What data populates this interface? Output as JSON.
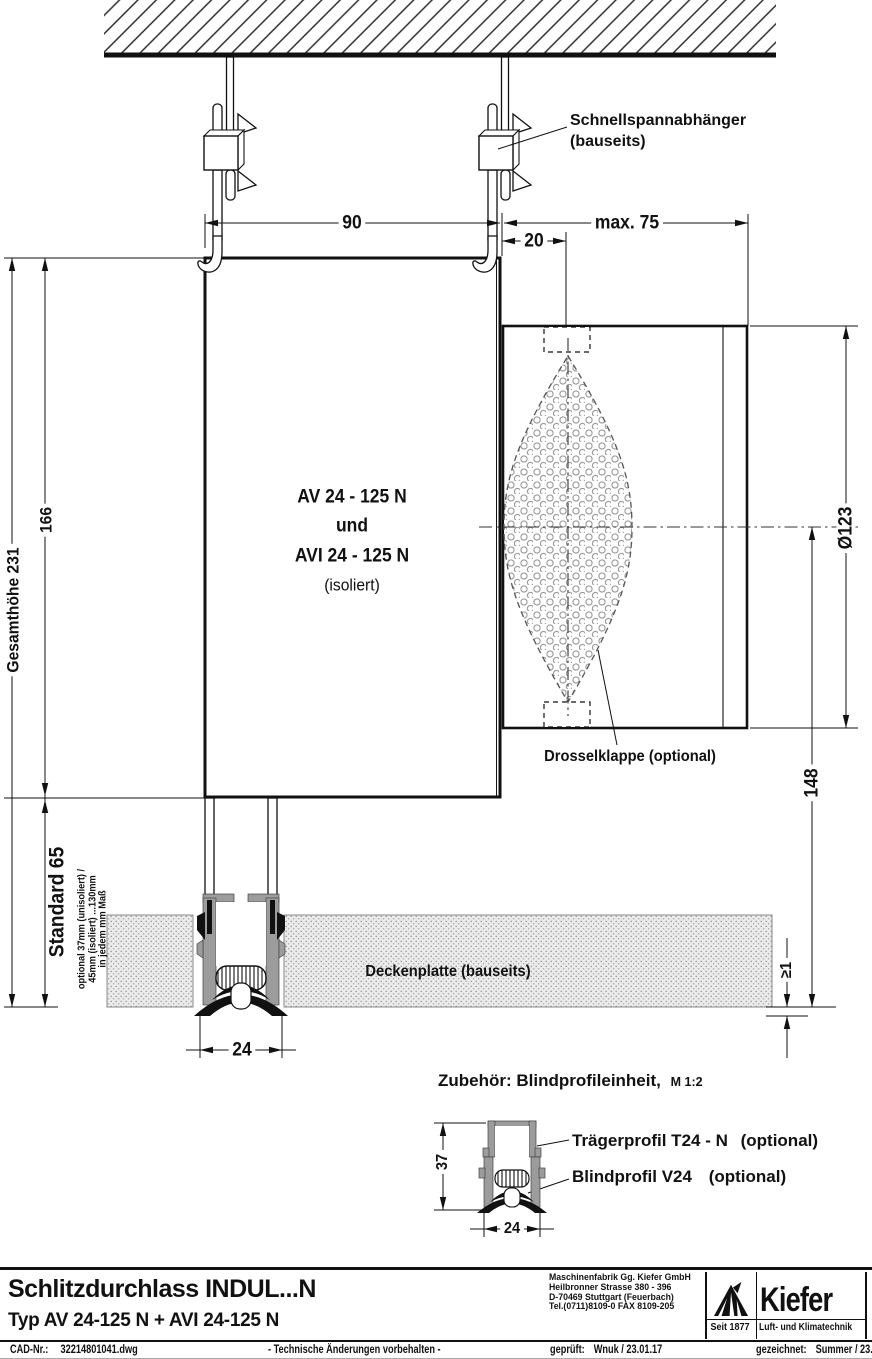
{
  "drawing": {
    "hanger_label_1": "Schnellspannabhänger",
    "hanger_label_2": "(bauseits)",
    "box_label_1": "AV 24 - 125 N",
    "box_label_2": "und",
    "box_label_3": "AVI 24 - 125 N",
    "box_label_4": "(isoliert)",
    "damper_label": "Drosselklappe (optional)",
    "ceiling_label": "Deckenplatte (bauseits)",
    "dims": {
      "hanger_spacing": "90",
      "max_offset": "max. 75",
      "axis_offset": "20",
      "total_height": "Gesamthöhe 231",
      "box_height": "166",
      "standard_height": "Standard 65",
      "optional_note_1": "optional 37mm (unisoliert) /",
      "optional_note_2": "45mm (isoliert) ...130mm",
      "optional_note_3": "in jedem mm Maß",
      "duct_diameter": "Ø123",
      "axis_to_ceiling": "148",
      "protrusion": "≥1",
      "slot_width": "24",
      "detail_height": "37",
      "detail_width": "24"
    },
    "accessory": {
      "heading": "Zubehör: Blindprofileinheit,",
      "scale": "M 1:2",
      "carrier_label": "Trägerprofil T24 - N",
      "carrier_opt": "(optional)",
      "blind_label": "Blindprofil V24",
      "blind_opt": "(optional)"
    }
  },
  "titleblock": {
    "title": "Schlitzdurchlass INDUL...N",
    "subtitle": "Typ AV 24-125 N + AVI 24-125 N",
    "company": [
      "Maschinenfabrik Gg. Kiefer GmbH",
      "Heilbronner Strasse 380 - 396",
      "D-70469 Stuttgart (Feuerbach)",
      "Tel.(0711)8109-0 FAX 8109-205"
    ],
    "brand": {
      "name": "Kiefer",
      "since": "Seit 1877",
      "tagline": "Luft- und Klimatechnik"
    },
    "cad_label": "CAD-Nr.:",
    "cad_number": "32214801041.dwg",
    "notice": "- Technische Änderungen vorbehalten -",
    "checked_label": "geprüft:",
    "checked_value": "Wnuk / 23.01.17",
    "drawn_label": "gezeichnet:",
    "drawn_value": "Summer / 23.01.17"
  },
  "colors": {
    "line": "#111111",
    "profile_gray": "#9c9c9c",
    "plate_fill": "#ebebeb"
  }
}
